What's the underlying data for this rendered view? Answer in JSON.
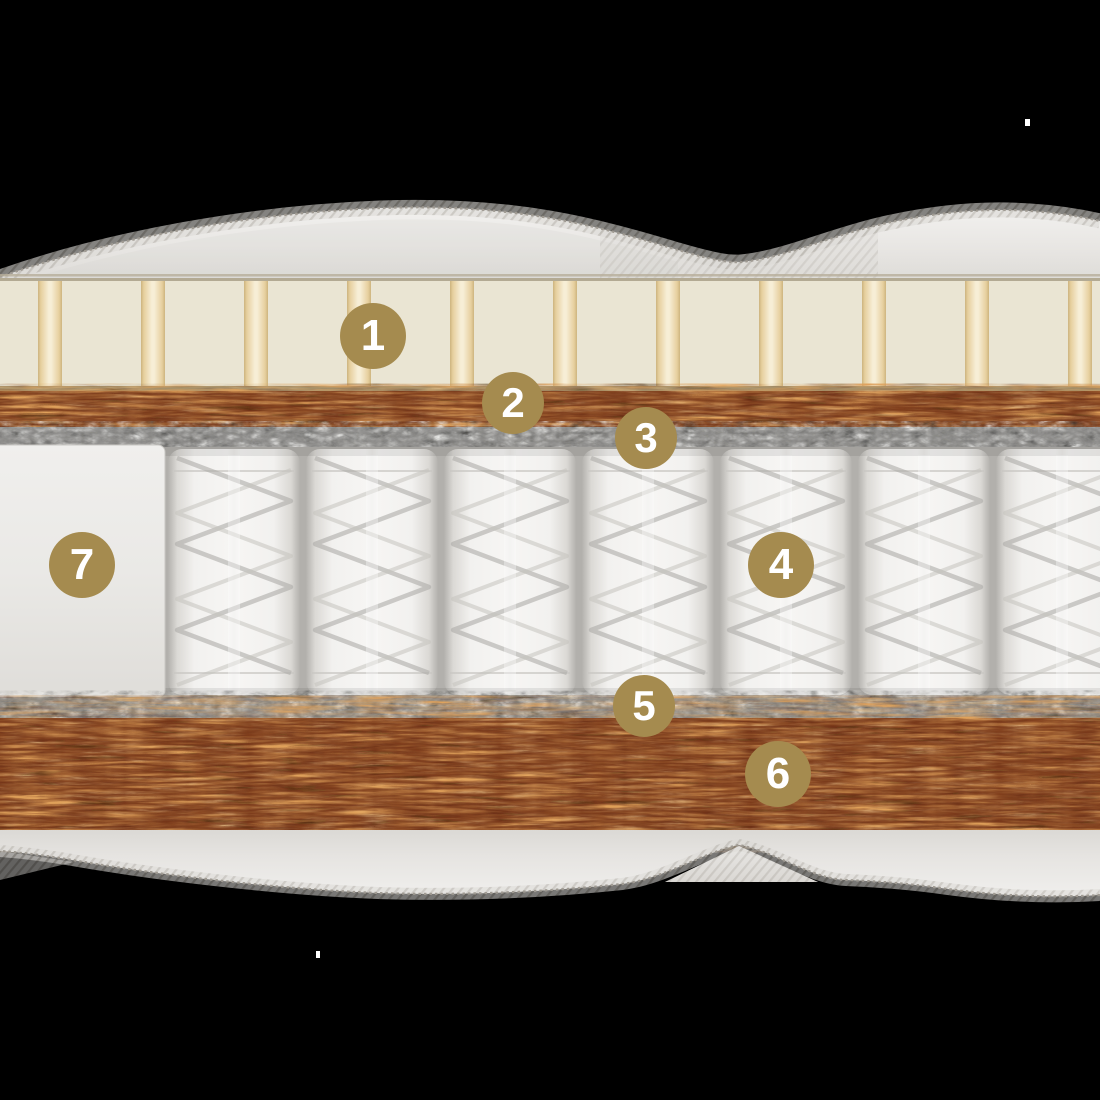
{
  "diagram": {
    "type": "mattress-layer-cross-section",
    "background_color": "#000000",
    "badge_style": {
      "fill": "#a58b4f",
      "text_color": "#ffffff"
    },
    "badges": [
      {
        "number": "1",
        "x": 373,
        "y": 336,
        "r": 33
      },
      {
        "number": "2",
        "x": 513,
        "y": 403,
        "r": 31
      },
      {
        "number": "3",
        "x": 646,
        "y": 438,
        "r": 31
      },
      {
        "number": "4",
        "x": 781,
        "y": 565,
        "r": 33
      },
      {
        "number": "5",
        "x": 644,
        "y": 706,
        "r": 31
      },
      {
        "number": "6",
        "x": 778,
        "y": 774,
        "r": 33
      },
      {
        "number": "7",
        "x": 82,
        "y": 565,
        "r": 33
      }
    ],
    "palette": {
      "background": "#000000",
      "cover": "#e7e5e2",
      "cover-shade": "#d7d4d0",
      "latex": "#eae5d3",
      "latex-stripe-edge": "#d9bd82",
      "latex-stripe-center": "#f6ead0",
      "latex-border": "#a6926c",
      "coir-base": "#7c3a1a",
      "coir-fiber-light": "#dfa059",
      "coir-fiber-pale": "#f3cf96",
      "coir-fiber-dark": "#2e1408",
      "felt-base": "#8f8e8c",
      "felt-light": "#fafaf8",
      "felt-dark": "#2f2f2d",
      "spring-gap": "#b2b0ac",
      "spring-pocket": "#f2f1ef",
      "spring-coil": "#aeaca8",
      "side-foam": "#eae9e6"
    }
  }
}
